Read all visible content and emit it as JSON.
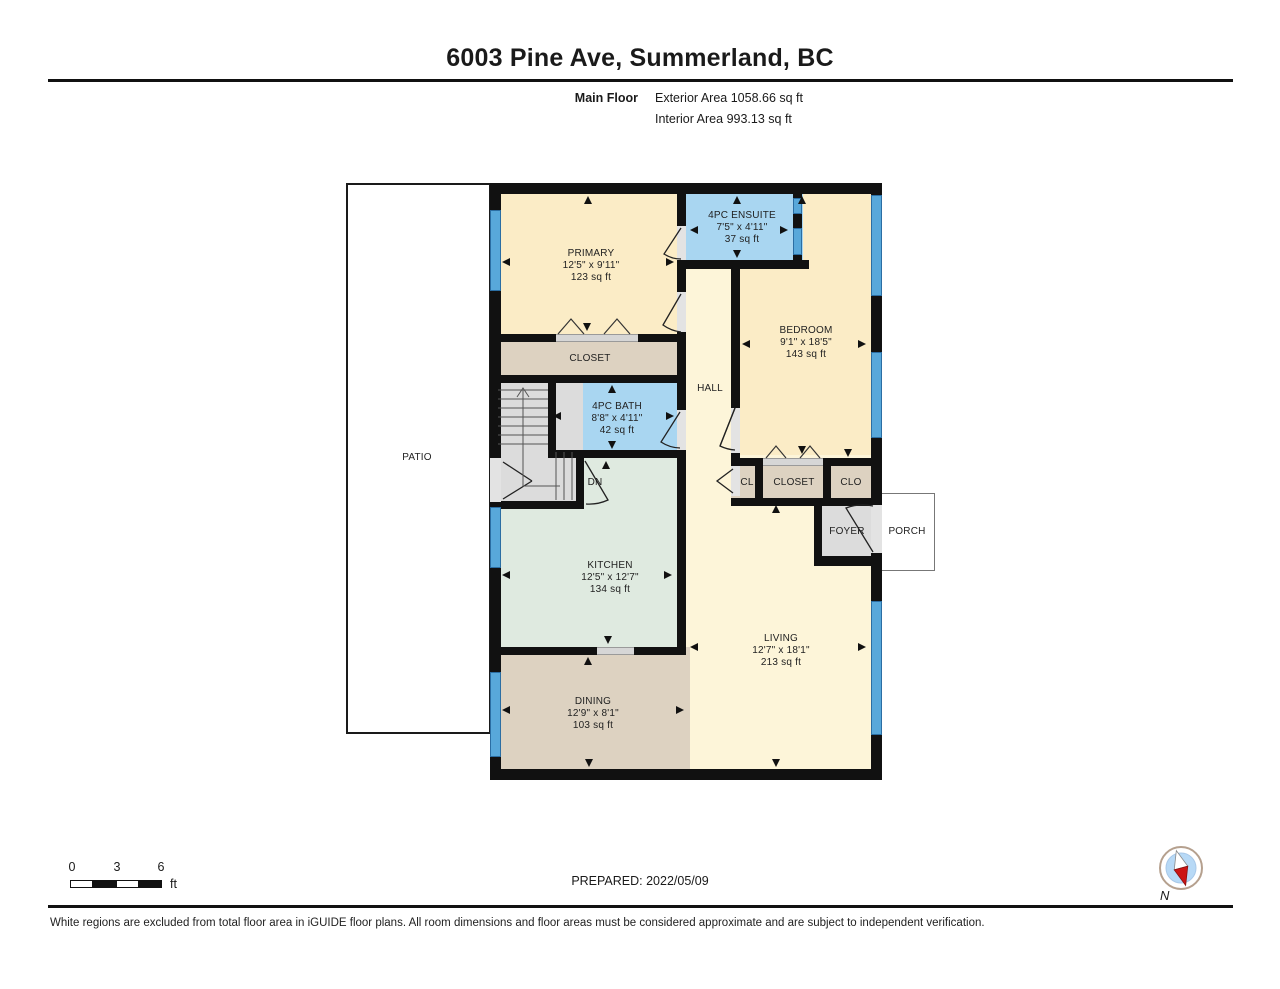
{
  "header": {
    "title": "6003 Pine Ave, Summerland, BC",
    "floor_label": "Main Floor",
    "exterior_area": "Exterior Area 1058.66 sq ft",
    "interior_area": "Interior Area 993.13 sq ft"
  },
  "rooms": {
    "primary": {
      "name": "PRIMARY",
      "dims": "12'5\" x 9'11\"",
      "area": "123 sq ft"
    },
    "ensuite": {
      "name": "4PC ENSUITE",
      "dims": "7'5\" x 4'11\"",
      "area": "37 sq ft"
    },
    "bedroom": {
      "name": "BEDROOM",
      "dims": "9'1\" x 18'5\"",
      "area": "143 sq ft"
    },
    "bath": {
      "name": "4PC BATH",
      "dims": "8'8\" x 4'11\"",
      "area": "42 sq ft"
    },
    "kitchen": {
      "name": "KITCHEN",
      "dims": "12'5\" x 12'7\"",
      "area": "134 sq ft"
    },
    "dining": {
      "name": "DINING",
      "dims": "12'9\" x 8'1\"",
      "area": "103 sq ft"
    },
    "living": {
      "name": "LIVING",
      "dims": "12'7\" x 18'1\"",
      "area": "213 sq ft"
    },
    "hall": {
      "name": "HALL"
    },
    "closet_primary": {
      "name": "CLOSET"
    },
    "cl": {
      "name": "CL"
    },
    "closet_bedroom": {
      "name": "CLOSET"
    },
    "clo": {
      "name": "CLO"
    },
    "foyer": {
      "name": "FOYER"
    },
    "patio": {
      "name": "PATIO"
    },
    "porch": {
      "name": "PORCH"
    },
    "stairs": {
      "dn_label": "DN"
    }
  },
  "scale_bar": {
    "t0": "0",
    "t3": "3",
    "t6": "6",
    "unit": "ft"
  },
  "footer": {
    "prepared": "PREPARED: 2022/05/09",
    "disclaimer": "White regions are excluded from total floor area in iGUIDE floor plans. All room dimensions and floor areas must be considered approximate and are subject to independent verification."
  },
  "compass": {
    "label": "N"
  },
  "colors": {
    "wall": "#111111",
    "window": "#58a8da",
    "room_cream": "#fbecc6",
    "room_cream_light": "#fdf5d9",
    "room_blue": "#a9d6f1",
    "room_tan": "#ddd2c1",
    "room_green": "#dfeae0",
    "room_gray": "#dcdcdc"
  }
}
